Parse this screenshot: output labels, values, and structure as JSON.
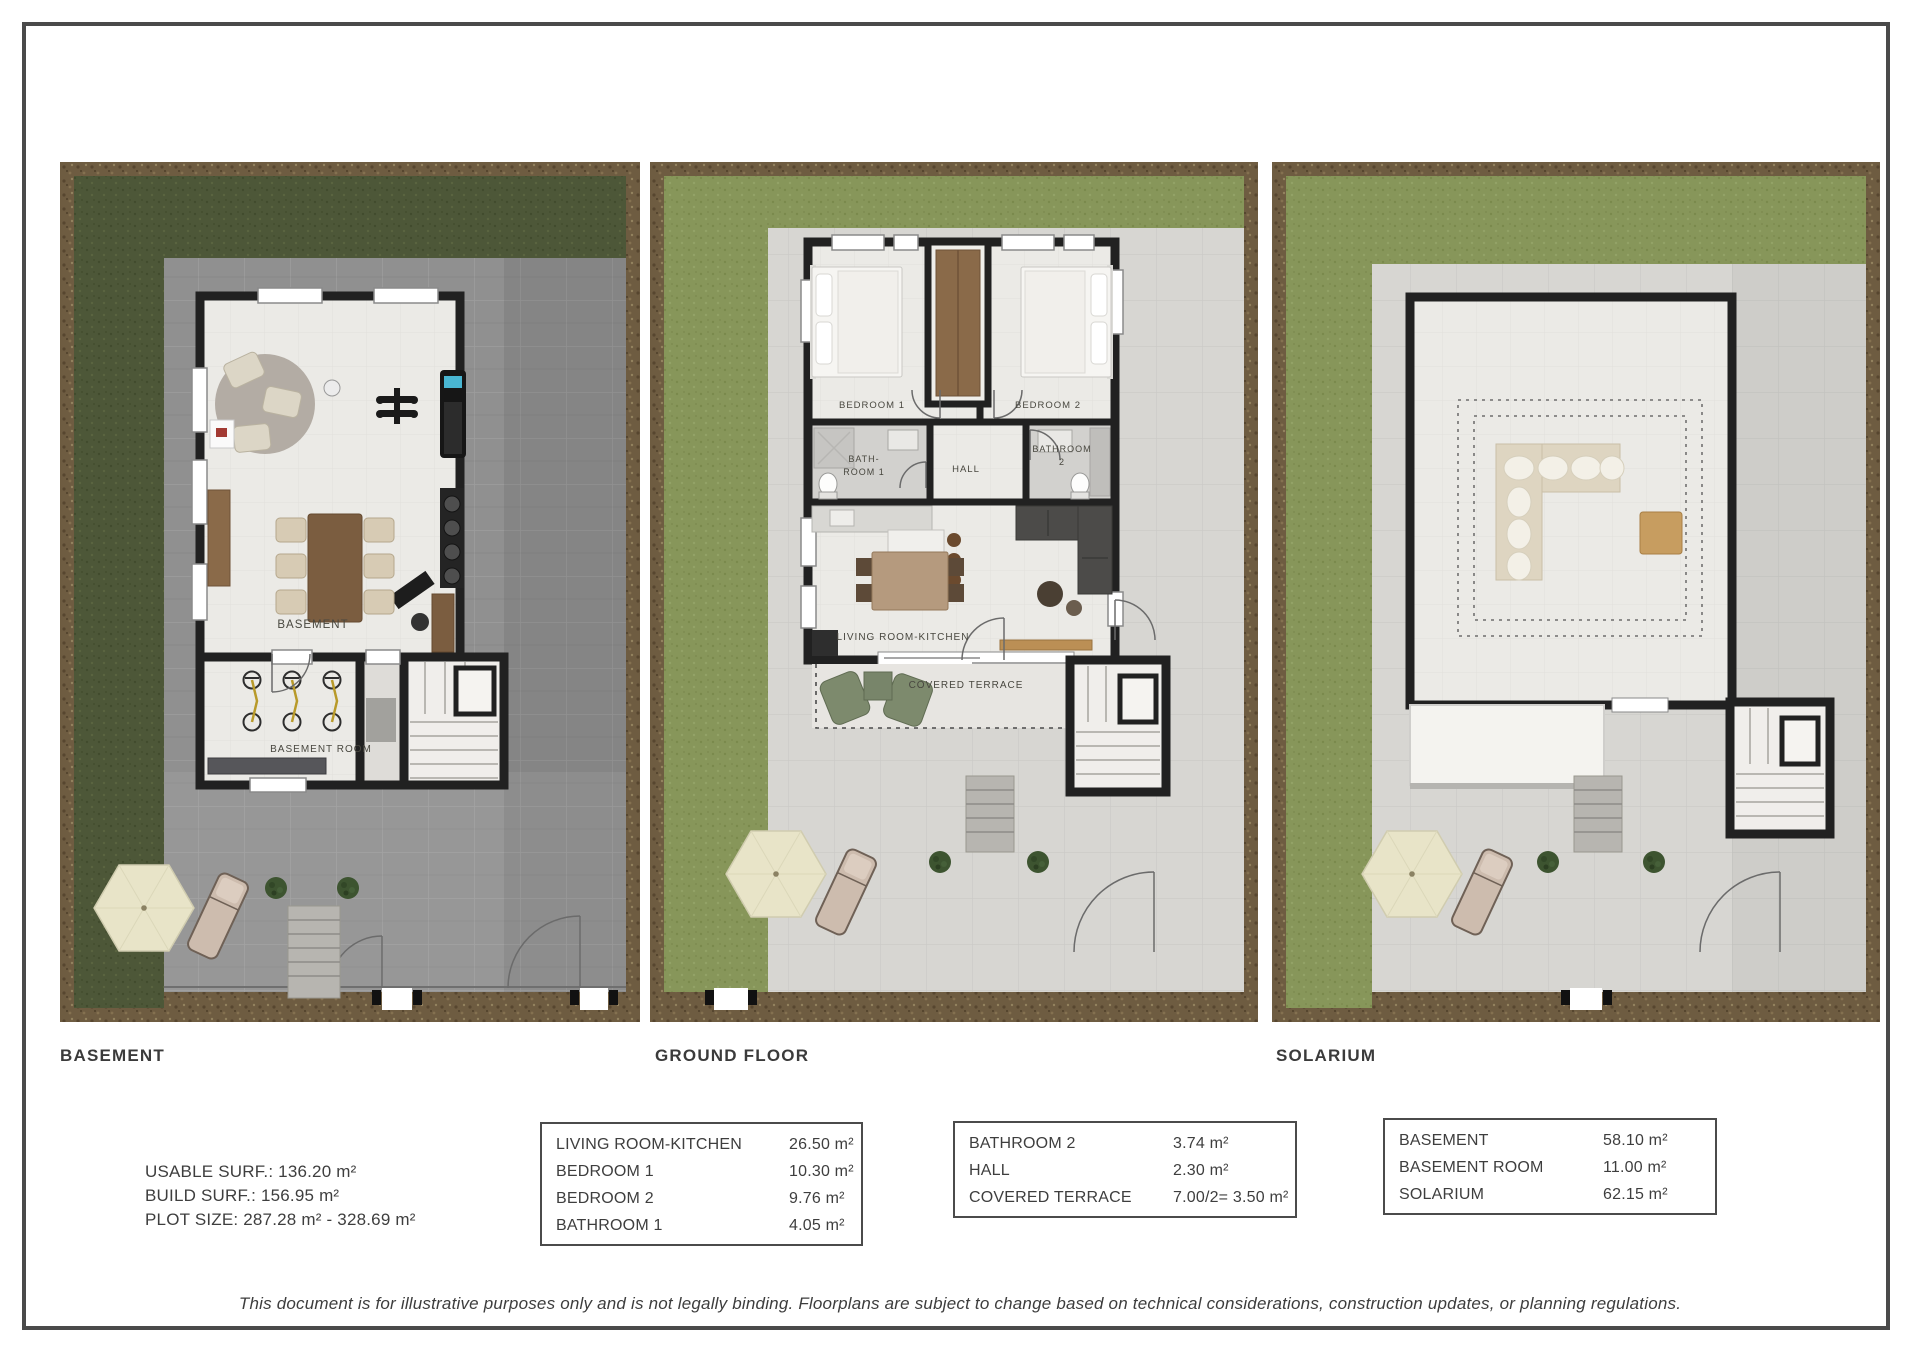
{
  "page": {
    "disclaimer": "This document is for illustrative purposes only and is not legally binding. Floorplans are subject to change based on technical considerations, construction updates, or planning regulations."
  },
  "colors": {
    "grass_dark": "#4d5738",
    "grass_light": "#87965a",
    "dirt": "#6e5c41",
    "paving_dark": "#909090",
    "paving_light": "#d7d6d2",
    "wall": "#212121",
    "floor": "#ebeae6",
    "text": "#3b3b3b"
  },
  "panels": {
    "basement": {
      "title": "BASEMENT",
      "rooms": {
        "main": "BASEMENT",
        "basement_room": "BASEMENT ROOM"
      }
    },
    "ground_floor": {
      "title": "GROUND FLOOR",
      "rooms": {
        "bedroom1": "BEDROOM 1",
        "bedroom2": "BEDROOM 2",
        "bathroom1_line1": "BATH-",
        "bathroom1_line2": "ROOM 1",
        "hall": "HALL",
        "bathroom2_line1": "BATHROOM",
        "bathroom2_line2": "2",
        "living": "LIVING ROOM-KITCHEN",
        "terrace": "COVERED TERRACE"
      }
    },
    "solarium": {
      "title": "SOLARIUM"
    }
  },
  "stats": {
    "line1": "USABLE SURF.: 136.20 m²",
    "line2": "BUILD SURF.: 156.95 m²",
    "line3": "PLOT SIZE: 287.28 m² - 328.69 m²"
  },
  "tables": {
    "table1": {
      "rows": [
        {
          "label": "LIVING ROOM-KITCHEN",
          "value": "26.50 m²"
        },
        {
          "label": "BEDROOM 1",
          "value": "10.30 m²"
        },
        {
          "label": "BEDROOM 2",
          "value": "9.76 m²"
        },
        {
          "label": "BATHROOM 1",
          "value": "4.05 m²"
        }
      ]
    },
    "table2": {
      "rows": [
        {
          "label": "BATHROOM 2",
          "value": "3.74 m²"
        },
        {
          "label": "HALL",
          "value": "2.30 m²"
        },
        {
          "label": "COVERED TERRACE",
          "value": "7.00/2= 3.50 m²"
        }
      ]
    },
    "table3": {
      "rows": [
        {
          "label": "BASEMENT",
          "value": "58.10 m²"
        },
        {
          "label": "BASEMENT ROOM",
          "value": "11.00 m²"
        },
        {
          "label": "SOLARIUM",
          "value": "62.15 m²"
        }
      ]
    }
  }
}
